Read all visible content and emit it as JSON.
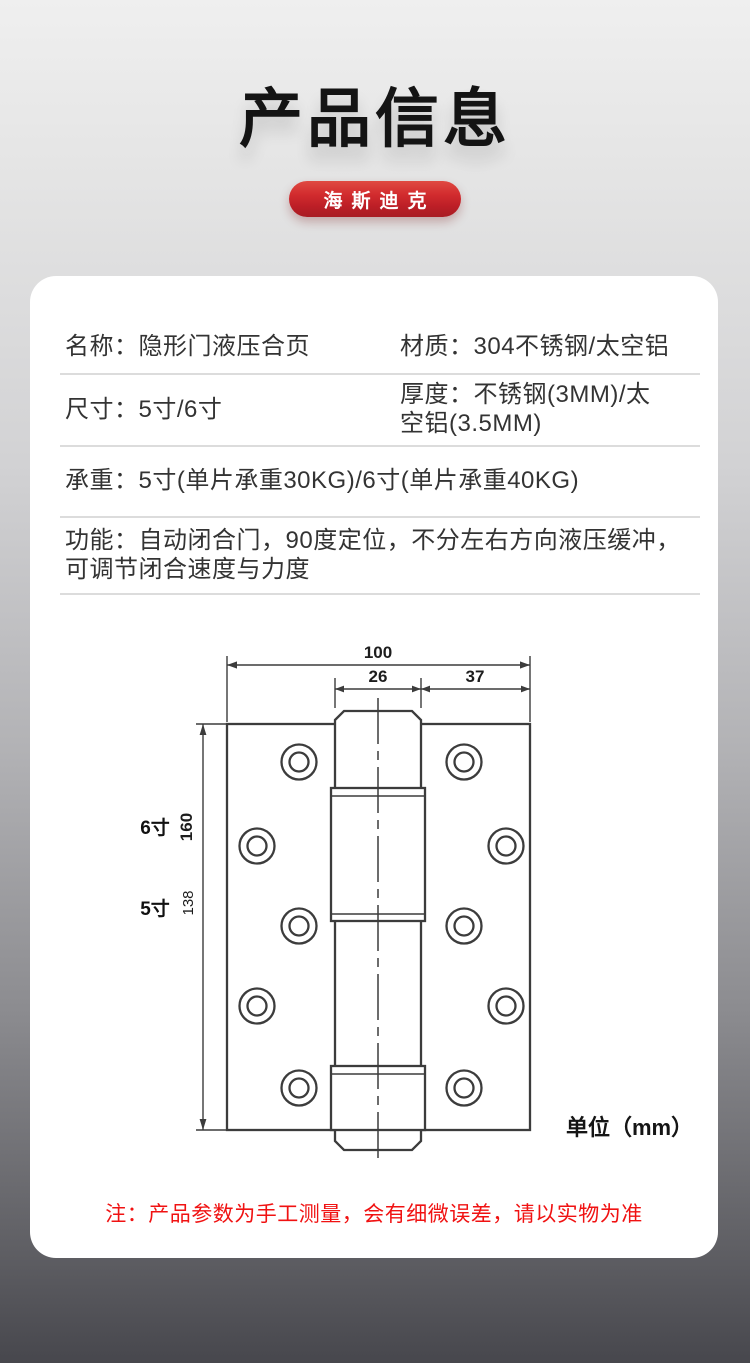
{
  "page": {
    "title": "产品信息",
    "brand": "海斯迪克",
    "note": "注：产品参数为手工测量，会有细微误差，请以实物为准"
  },
  "specs": {
    "name_label": "名称：",
    "name_value": "隐形门液压合页",
    "material_label": "材质：",
    "material_value": "304不锈钢/太空铝",
    "size_label": "尺寸：",
    "size_value": "5寸/6寸",
    "thickness_label": "厚度：",
    "thickness_value": "不锈钢(3MM)/太空铝(3.5MM)",
    "load_label": "承重：",
    "load_value": "5寸(单片承重30KG)/6寸(单片承重40KG)",
    "function_label": "功能：",
    "function_value": "自动闭合门，90度定位，不分左右方向液压缓冲，可调节闭合速度与力度"
  },
  "diagram": {
    "dim_total_width": "100",
    "dim_barrel_width": "26",
    "dim_side_width": "37",
    "dim_height_6inch": "160",
    "dim_height_5inch": "138",
    "label_6inch": "6寸",
    "label_5inch": "5寸",
    "unit": "单位（mm）"
  },
  "colors": {
    "brand_red": "#c2202a",
    "note_red": "#f01212"
  }
}
